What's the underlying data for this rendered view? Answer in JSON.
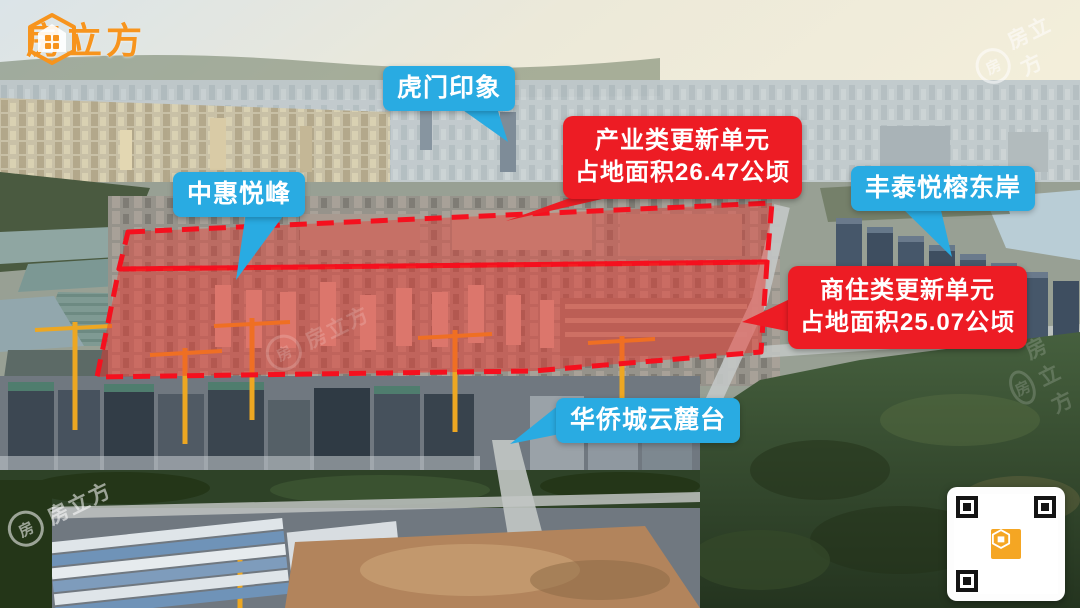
{
  "brand": {
    "logo_text": "房立方"
  },
  "watermark": {
    "text": "房立方"
  },
  "colors": {
    "brand_orange": "#f7941d",
    "label_blue": "#29abe2",
    "label_red": "#ed1c24",
    "zone_outline_red": "#f5101e",
    "zone_fill_red": "rgba(242,45,38,0.44)"
  },
  "labels": {
    "project_labels": [
      {
        "id": "humen-impression",
        "text": "虎门印象"
      },
      {
        "id": "zhonghui-yuefeng",
        "text": "中惠悦峰"
      },
      {
        "id": "fengtai-yuerong-east-bank",
        "text": "丰泰悦榕东岸"
      },
      {
        "id": "oct-yunlutai",
        "text": "华侨城云麓台"
      }
    ],
    "zone_labels": [
      {
        "id": "industrial-renewal-unit",
        "line1": "产业类更新单元",
        "line2": "占地面积26.47公顷"
      },
      {
        "id": "commercial-residential-renewal-unit",
        "line1": "商住类更新单元",
        "line2": "占地面积25.07公顷"
      }
    ]
  },
  "zones": [
    {
      "id": "industrial-zone",
      "area_hectares": 26.47
    },
    {
      "id": "commercial-residential-zone",
      "area_hectares": 25.07
    }
  ]
}
